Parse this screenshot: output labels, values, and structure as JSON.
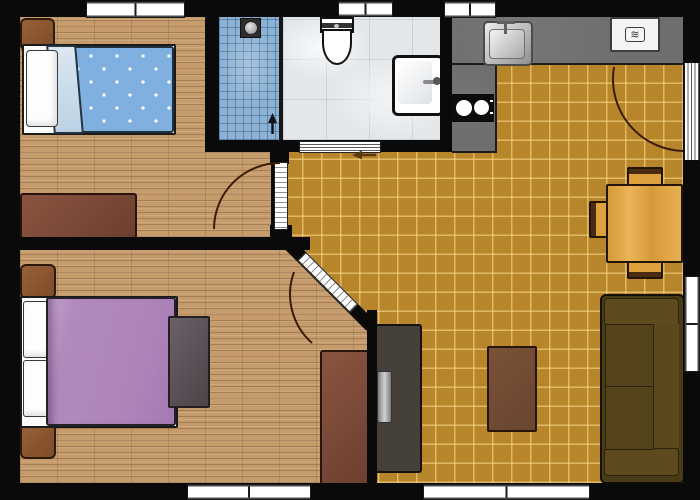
{
  "title": "Apartment floor plan (top-down view)",
  "icons": {
    "microwave_glyph": "≋"
  },
  "rooms": [
    {
      "id": "bedroom-1",
      "floor": "wood plank",
      "furniture": [
        "single bed with blue dotted duvet",
        "white pillow",
        "folded light-blue blanket",
        "brown nightstand",
        "brown dresser"
      ],
      "openings": [
        "window top wall",
        "hinged door to hallway with swing arc"
      ]
    },
    {
      "id": "bathroom",
      "floor": "light marble tile",
      "fixtures": [
        "toilet with cistern",
        "washbasin with faucet",
        "shower area with blue mosaic floor",
        "shower drain",
        "shower entry arrow"
      ],
      "openings": [
        "window top wall",
        "sliding door with direction arrow"
      ]
    },
    {
      "id": "kitchen",
      "floor": "ochre ceramic tile",
      "fixtures": [
        "L-shaped gray countertop",
        "stainless steel sink",
        "two-burner cooktop",
        "microwave oven"
      ],
      "openings": [
        "window top wall",
        "glazed terrace door with swing arc in right wall"
      ]
    },
    {
      "id": "living-room",
      "floor": "ochre ceramic tile",
      "furniture": [
        "square wooden dining table",
        "three wooden chairs",
        "dark two-seat sofa",
        "brown coffee table",
        "TV cabinet with television"
      ],
      "openings": [
        "window right wall",
        "window bottom wall"
      ]
    },
    {
      "id": "bedroom-2",
      "floor": "wood plank",
      "furniture": [
        "double bed with purple duvet",
        "two white pillows",
        "two brown nightstands",
        "brown wardrobe",
        "gray dresser"
      ],
      "openings": [
        "window bottom wall",
        "hinged door in diagonal wall with swing arc"
      ]
    }
  ],
  "colors": {
    "wall": "#0a0a0a",
    "wood_floor": "#c69c6d",
    "tile_floor": "#b8862a",
    "bathroom_floor": "#e4e7ea",
    "shower_tile": "#8cb2d4",
    "countertop": "#6e6e6e",
    "bed1_duvet": "#7fb0e0",
    "bed2_duvet": "#b18abd",
    "sofa": "#4a3b17",
    "dining_wood": "#dfa13e",
    "dark_wood_furniture": "#7d4b39",
    "door_arc": "#3a1d06"
  }
}
